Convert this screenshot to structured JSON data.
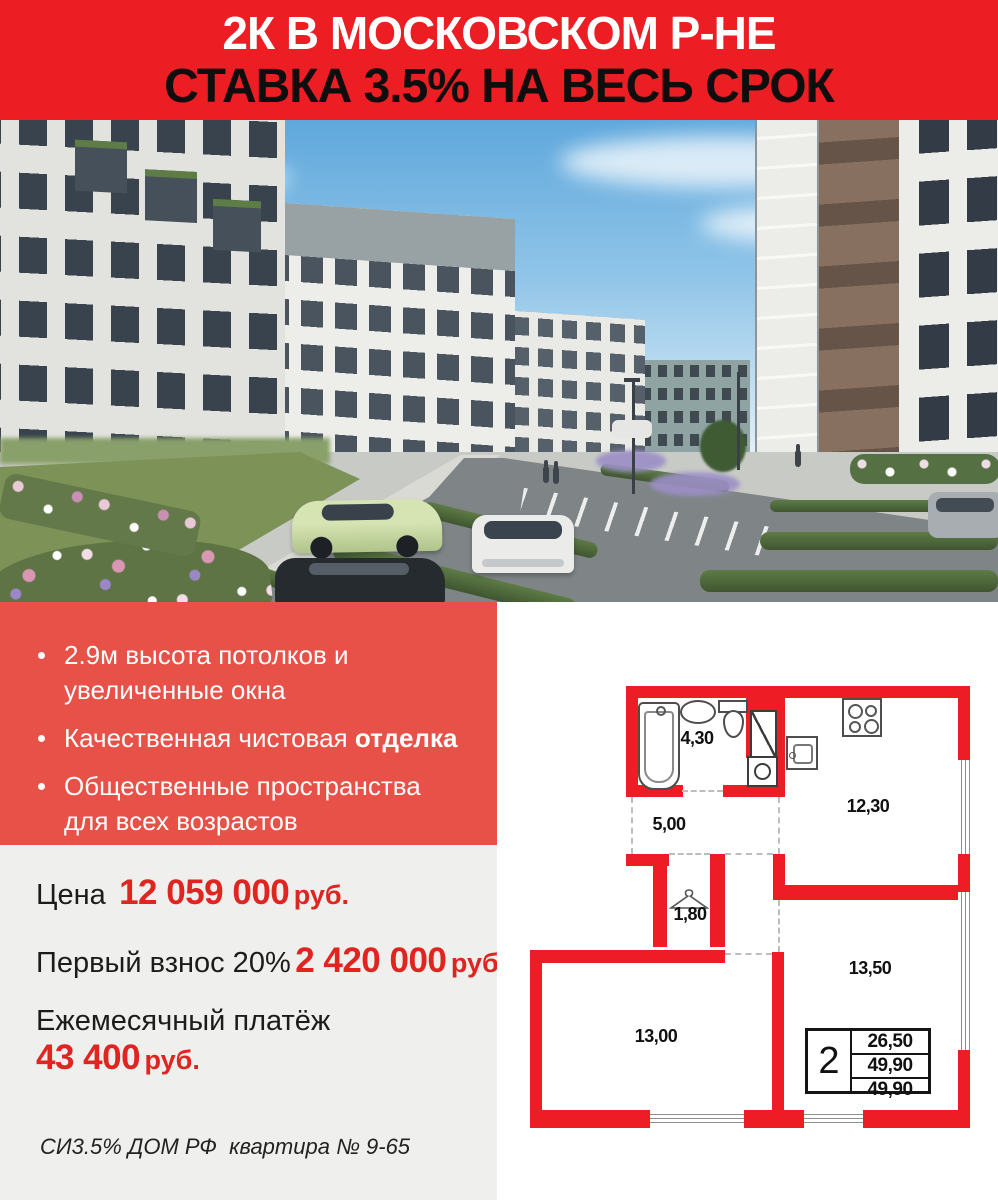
{
  "header": {
    "line1": "2К В МОСКОВСКОМ Р-НЕ",
    "line2": "СТАВКА 3.5% НА ВЕСЬ СРОК"
  },
  "colors": {
    "header_bg": "#EC1D23",
    "features_bg": "#E75147",
    "accent_red": "#E02420",
    "gray_bg": "#EFEFED",
    "plan_wall_red": "#EE1C25"
  },
  "features": {
    "items": [
      {
        "lead": "2.9м высота потолков и увеличенные окна",
        "bold": ""
      },
      {
        "lead": "Качественная чистовая ",
        "bold": "отделка"
      },
      {
        "lead": "Общественные пространства для всех возрастов",
        "bold": ""
      }
    ]
  },
  "pricing": {
    "rows": [
      {
        "label": "Цена",
        "value": "12 059 000",
        "unit": "руб."
      },
      {
        "label": "Первый взнос 20%",
        "value": "2 420 000",
        "unit": "руб."
      },
      {
        "label": "Ежемесячный платёж",
        "value": "43 400",
        "unit": "руб."
      }
    ],
    "note": "СИ3.5% ДОМ РФ  квартира № 9-65"
  },
  "floorplan": {
    "rooms": [
      {
        "name": "bathroom",
        "area": "4,30"
      },
      {
        "name": "hallway",
        "area": "5,00"
      },
      {
        "name": "kitchen",
        "area": "12,30"
      },
      {
        "name": "wardrobe",
        "area": "1,80"
      },
      {
        "name": "bedroom",
        "area": "13,50"
      },
      {
        "name": "living-room",
        "area": "13,00"
      }
    ],
    "spec": {
      "rooms": "2",
      "row1": "26,50",
      "row2": "49,90",
      "row3": "49,90"
    }
  }
}
